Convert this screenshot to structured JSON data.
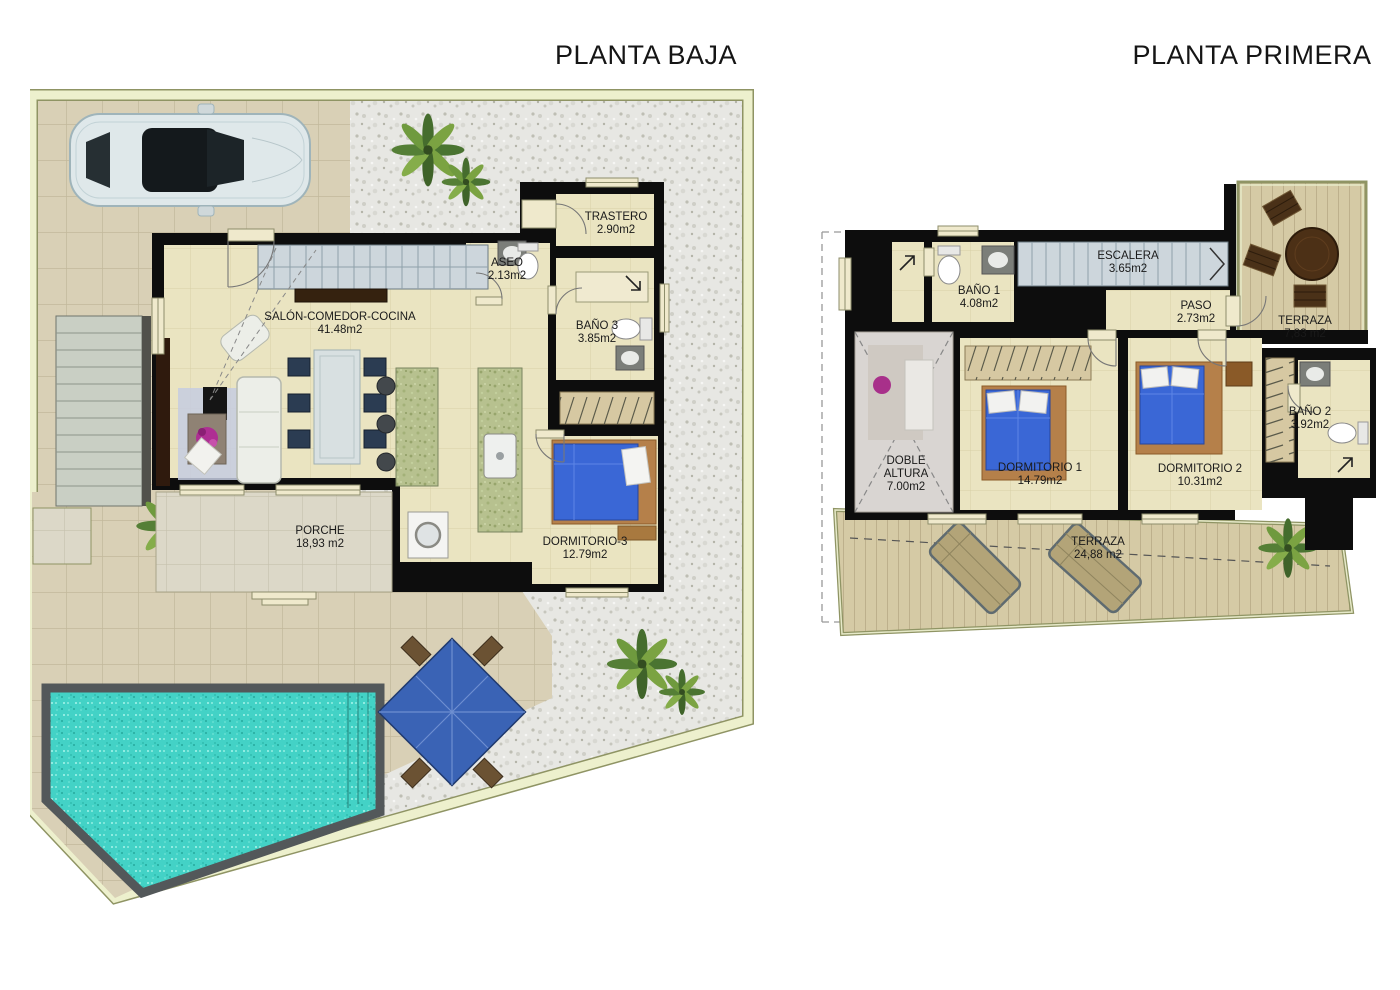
{
  "page": {
    "background": "#ffffff"
  },
  "colors": {
    "wall": "#0d0d0d",
    "floor": "#eae4c1",
    "tile": "#d9d0b6",
    "gravel": "#e7e7e3",
    "pool_water": "#43d2c6",
    "pool_edge": "#53585a",
    "deck_wood": "#d5caa5",
    "plot_border": "#edf0cd",
    "bed": "#3a67d6",
    "stairs": "#cdd6dc",
    "kitchen_counter": "#b7c18f",
    "label_text": "#1a1a1a"
  },
  "plans": {
    "planta_baja": {
      "title": "PLANTA BAJA",
      "rooms": [
        {
          "name": "SALÓN-COMEDOR-COCINA",
          "area": "41.48m2"
        },
        {
          "name": "ASEO",
          "area": "2.13m2"
        },
        {
          "name": "TRASTERO",
          "area": "2.90m2"
        },
        {
          "name": "BAÑO 3",
          "area": "3.85m2"
        },
        {
          "name": "DORMITORIO-3",
          "area": "12.79m2"
        },
        {
          "name": "PORCHE",
          "area": "18,93 m2"
        }
      ]
    },
    "planta_primera": {
      "title": "PLANTA PRIMERA",
      "rooms": [
        {
          "name": "BAÑO 1",
          "area": "4.08m2"
        },
        {
          "name": "ESCALERA",
          "area": "3.65m2"
        },
        {
          "name": "PASO",
          "area": "2.73m2"
        },
        {
          "name": "TERRAZA",
          "area": "7,83 m2"
        },
        {
          "name": "DOBLE",
          "name2": "ALTURA",
          "area": "7.00m2"
        },
        {
          "name": "DORMITORIO 1",
          "area": "14.79m2"
        },
        {
          "name": "DORMITORIO 2",
          "area": "10.31m2"
        },
        {
          "name": "BAÑO 2",
          "area": "3.92m2"
        },
        {
          "name": "TERRAZA",
          "area": "24,88 m2"
        }
      ]
    }
  }
}
